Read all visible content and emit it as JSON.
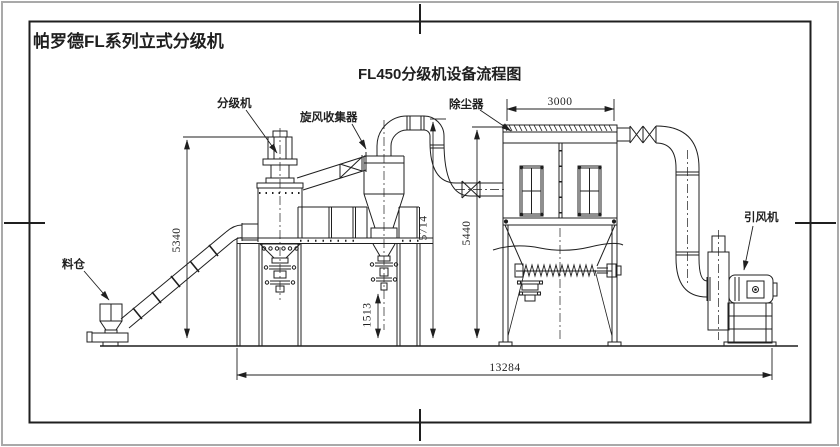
{
  "sheet": {
    "title": "帕罗德FL系列立式分级机",
    "drawing_title": "FL450分级机设备流程图"
  },
  "labels": {
    "classifier": "分级机",
    "cyclone_collector": "旋风收集器",
    "dust_collector": "除尘器",
    "induced_draft_fan": "引风机",
    "feed_bin": "料仓"
  },
  "dimensions": {
    "dust_collector_width": "3000",
    "classifier_height": "5340",
    "duct_top_height": "5714",
    "dust_collector_height": "5440",
    "cyclone_discharge_clearance": "1513",
    "overall_length": "13284"
  },
  "colors": {
    "line": "#1f1f1f",
    "outer_frame": "#a9a9a9",
    "background": "#ffffff"
  }
}
